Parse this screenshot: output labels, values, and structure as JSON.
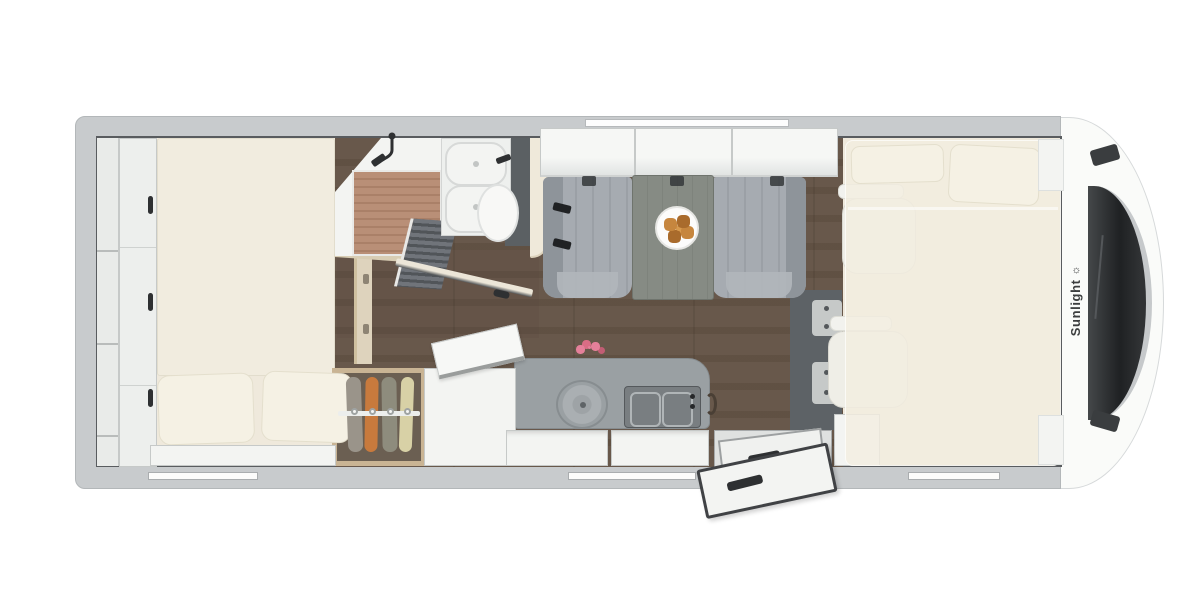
{
  "brand": {
    "label": "Sunlight",
    "logo_glyph": "☼"
  },
  "areas": [
    "rear-bed",
    "rear-wardrobe",
    "shelf-column",
    "shower",
    "washbasin",
    "toilet",
    "clothes-wardrobe",
    "refrigerator",
    "kitchen-counter",
    "sink",
    "hob",
    "dinette-bench-left",
    "dinette-bench-right",
    "dinette-table",
    "overhead-lockers",
    "entry-door",
    "cab-seat-left",
    "cab-seat-right",
    "drop-down-bed",
    "cab-front",
    "windshield"
  ],
  "counts": {
    "overhead_locker_sections": 3,
    "hob_burners": 2,
    "wardrobe_garments": 4,
    "rear_bed_pillows": 2,
    "drop_down_bed_pillows": 2,
    "bottom_wall_windows": 3,
    "washbasins": 2
  },
  "colors": {
    "bg": "#ffffff",
    "wall": "#c8cbcd",
    "wallEdge": "#b3b7b9",
    "innerLine": "#595c5f",
    "interior": "#efe9dc",
    "woodA": "#a3968a",
    "woodB": "#97897c",
    "bathShade": "rgba(84,70,58,0.15)",
    "white": "#f3f4f2",
    "whiteEdge": "#c6c9c8",
    "mattress": "#f1ecdf",
    "mattressEdge": "#e2ddcd",
    "pillow": "#f5f1e4",
    "pillowEdge": "#e4dfcd",
    "slatA": "#b98f77",
    "slatB": "#aa8068",
    "darkPanel": "#5b6063",
    "dark": "#2e3032",
    "beige": "#efe9da",
    "beigeEdge": "#ddd3bd",
    "benchA": "#a6abb1",
    "benchB": "#9ba0a6",
    "benchBack": "#8e949a",
    "benchFront": "#b1b6bb",
    "tableA": "#868b84",
    "tableB": "#7e837c",
    "counter": "#9aa0a3",
    "counterEdge": "#868c8f",
    "hob": "#797e81",
    "hobEdge": "#55595c",
    "grate": "#b0b5b7",
    "woodFrame": "#c9b494",
    "wardrobeIn": "#6b5f52",
    "g1": "#9a948a",
    "g2": "#c87a3d",
    "g3": "#8e8c7d",
    "g4": "#d8d1a6",
    "darkFloor": "#5d6266",
    "bracket": "#c6c9c8",
    "bedOverlay": "rgba(243,238,224,0.8)",
    "seat": "#efeee7",
    "seatEdge": "#d9d8d0",
    "windshieldA": "#3a3d3f",
    "windshieldB": "#1f2123",
    "chrome": "#c6c9cb",
    "logoText": "#3c3e3f",
    "cap": "#fafbf9",
    "capEdge": "#d6d9da",
    "doorEdge": "#404245",
    "plate": "#fcfcfb",
    "plateEdge": "#e6e6e3",
    "croA": "#c6863e",
    "croB": "#a96b2c",
    "croC": "#d79a4f",
    "pink": "#e5809a",
    "toiletW": "#f8f8f6",
    "toiletEdge": "#dfe1e0",
    "rail": "#eceeec"
  }
}
